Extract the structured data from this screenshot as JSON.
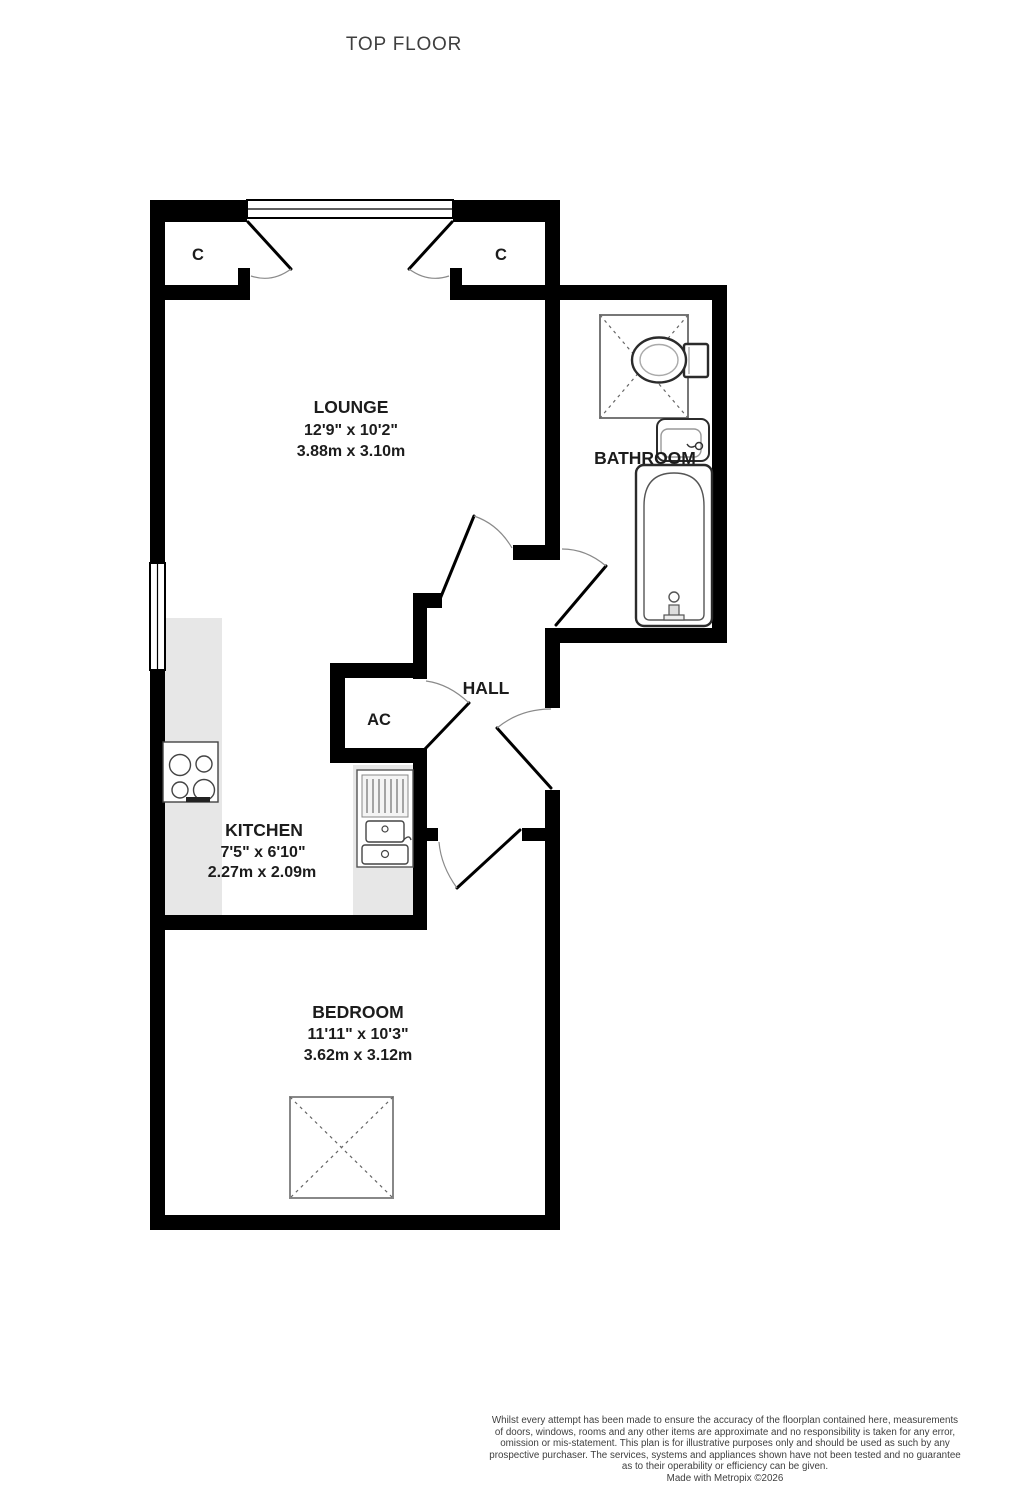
{
  "title": "TOP FLOOR",
  "plan": {
    "rooms": {
      "lounge": {
        "name": "LOUNGE",
        "imperial": "12'9\" x 10'2\"",
        "metric": "3.88m x 3.10m"
      },
      "bathroom": {
        "name": "BATHROOM"
      },
      "hall": {
        "name": "HALL"
      },
      "ac": {
        "name": "AC"
      },
      "kitchen": {
        "name": "KITCHEN",
        "imperial": "7'5\" x 6'10\"",
        "metric": "2.27m x 2.09m"
      },
      "bedroom": {
        "name": "BEDROOM",
        "imperial": "11'11\" x 10'3\"",
        "metric": "3.62m x 3.12m"
      },
      "closet_left": {
        "name": "C"
      },
      "closet_right": {
        "name": "C"
      }
    }
  },
  "footer": {
    "disclaimer_lines": [
      "Whilst every attempt has been made to ensure the accuracy of the floorplan contained here, measurements",
      "of doors, windows, rooms and any other items are approximate and no responsibility is taken for any error,",
      "omission or mis-statement. This plan is for illustrative purposes only and should be used as such by any",
      "prospective purchaser. The services, systems and appliances shown have not been tested and no guarantee",
      "as to their operability or efficiency can be given."
    ],
    "credit": "Made with Metropix ©2026"
  },
  "colors": {
    "wall": "#000000",
    "counter": "#e7e7e7",
    "label": "#1c1c1c",
    "muted_text": "#3f3f3f",
    "fixture_outline": "#2b2b2b",
    "fixture_light": "#777777",
    "background": "#ffffff"
  }
}
